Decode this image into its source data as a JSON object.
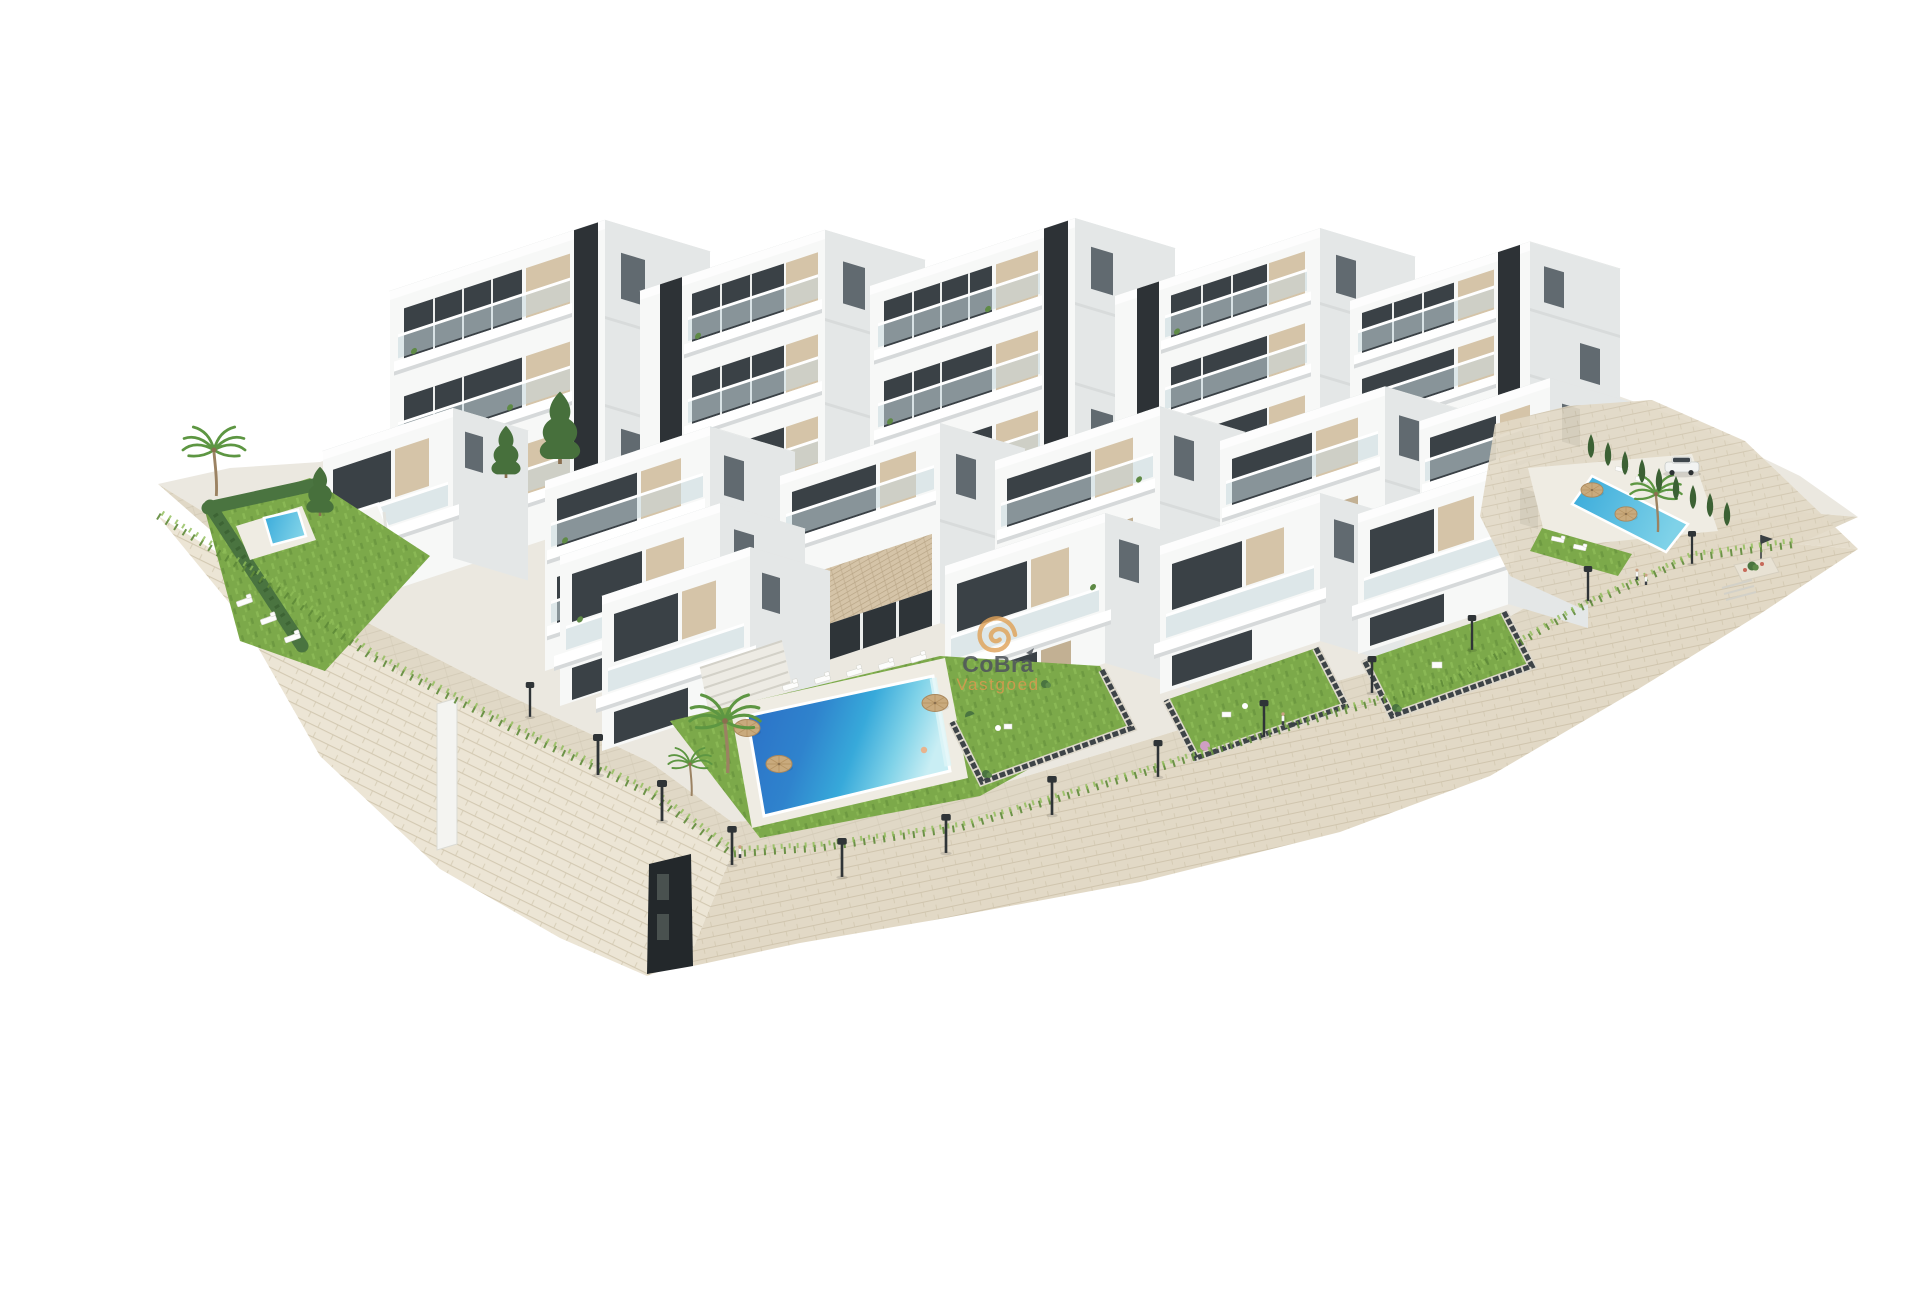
{
  "meta": {
    "type": "architectural-3d-render",
    "width": 1920,
    "height": 1280,
    "background": "#ffffff",
    "subject": "Aerial 3D visualization of a white terraced apartment complex with communal pools, private lawned gardens and curved stone retaining walls on a white background"
  },
  "watermark": {
    "brand": "CoBra",
    "subtitle": "Vastgoed",
    "icon": "spiral-logo-icon",
    "brand_color": "#50565c",
    "subtitle_color": "#d79a4f"
  },
  "palette": {
    "bg": "#ffffff",
    "wFront": "#f7f8f7",
    "wFront2": "#eff1f0",
    "wSide": "#e4e7e7",
    "wTop": "#f3f4f3",
    "win": "#3a4146",
    "core": "#2d3236",
    "beige": "#d5c4a8",
    "beige2": "#c2b093",
    "glass": "#c9d8de",
    "pergola": "#c4ae8c",
    "stoneL": "#ece5d5",
    "stoneF": "#e2d9c6",
    "stoneLine": "#cdc2a9",
    "pave": "#ded6c3",
    "paveLine": "#ccc3ad",
    "terrace": "#ebe8e0",
    "deck": "#efece3",
    "grass": "#7ca94a",
    "grass2": "#8fbd58",
    "grassD": "#5e8a38",
    "hedge": "#4a7440",
    "cypress": "#3c6134",
    "palm": "#5d9642",
    "trunk": "#9b8262",
    "poolDeep": "#2b6ec6",
    "poolMid": "#37a9da",
    "poolLt": "#7fd2e8",
    "poolPale": "#c9eef4",
    "poolSmall": "#4cc2dc",
    "lamp": "#2f3437",
    "fence": "#3e4448",
    "fenceBase": "#ddd8cc",
    "sand": "#c9aa7d",
    "carBody": "#f2f3f2",
    "carGlass": "#3e464c",
    "wmGray": "#50565c",
    "wmOrange": "#d79a4f",
    "wmSpiral": "#e0a258"
  },
  "scene": {
    "elements": [
      "stone-retaining-wall",
      "promenade",
      "apartment-buildings",
      "rooftop-pergolas",
      "glass-balconies",
      "private-gardens",
      "communal-pool-main",
      "pool-left-garden",
      "pool-right",
      "cypress-hedge",
      "palm-trees",
      "pine-trees",
      "sun-loungers",
      "straw-umbrellas",
      "street-lamps",
      "parked-car",
      "pedestrians",
      "entrance-stairs"
    ]
  }
}
